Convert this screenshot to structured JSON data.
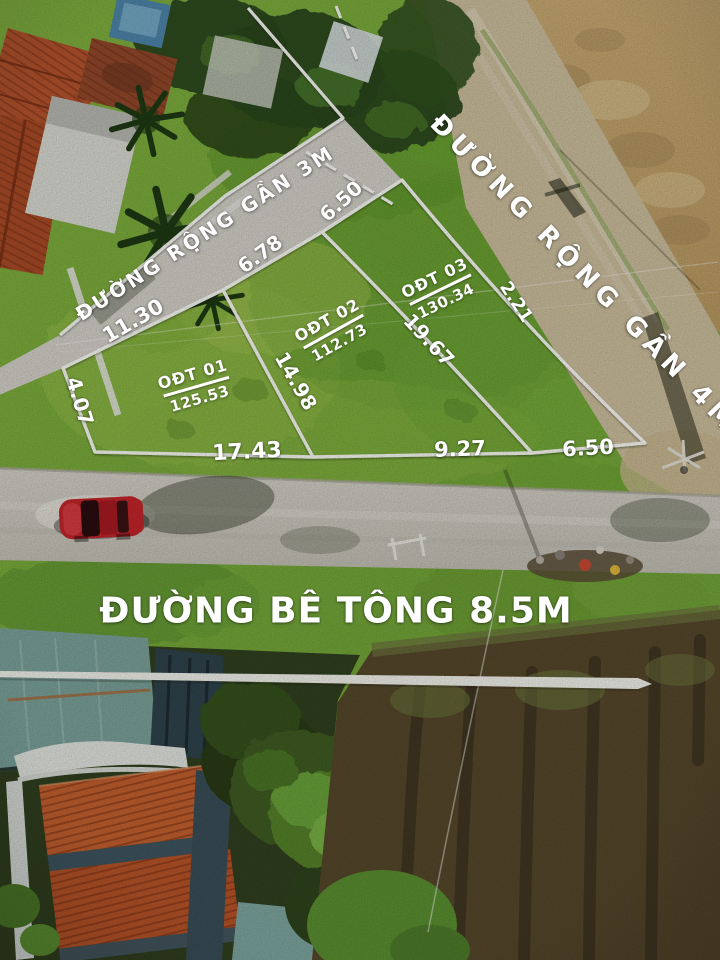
{
  "road_labels": {
    "road_3m": "ĐƯỜNG RỘNG GẦN 3M",
    "road_4m": "ĐƯỜNG RỘNG GẦN 4M",
    "road_concrete": "ĐƯỜNG BÊ TÔNG 8.5M"
  },
  "plots": [
    {
      "code": "OĐT 01",
      "area": "125.53"
    },
    {
      "code": "OĐT 02",
      "area": "112.73"
    },
    {
      "code": "OĐT 03",
      "area": "130.34"
    }
  ],
  "measurements": {
    "left_edge": "4.07",
    "top_edge_1": "11.30",
    "top_edge_2": "6.78",
    "top_edge_3": "6.50",
    "right_edge": "2.21",
    "divider_1": "14.98",
    "divider_2": "19.67",
    "bottom_edge_1": "17.43",
    "bottom_edge_2": "9.27",
    "bottom_edge_3": "6.50"
  },
  "colors": {
    "annotation": "#ffffff",
    "grass": "#76a93a",
    "dirt_road": "#cdbf9e",
    "concrete_road": "#cfccc3",
    "car": "#c4252b",
    "roof_tile": "#c4602f",
    "dark_field": "#56482b"
  }
}
